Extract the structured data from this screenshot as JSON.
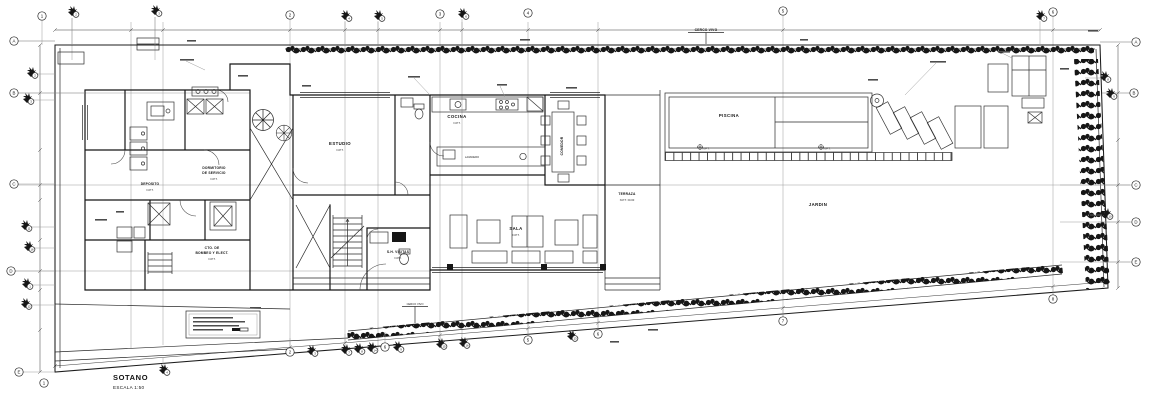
{
  "titleblock": {
    "title": "SOTANO",
    "scale": "ESCALA 1:50"
  },
  "site": {
    "top_hedge": "CERCO VIVO",
    "bottom_hedge": "CERCO VIVO",
    "jardin": "JARDIN",
    "terraza": "TERRAZA",
    "terraza_npt": "N.P.T. ±0.00"
  },
  "rooms": {
    "piscina": "PISCINA",
    "estudio": "ESTUDIO",
    "cocina": "COCINA",
    "lavadero": "LAVADERO",
    "comedor": "COMEDOR",
    "sala": "SALA",
    "dormitorio1": "DORMITORIO",
    "dormitorio2": "DE SERVICIO",
    "deposito": "DEPOSITO",
    "bombas1": "CTO. DE",
    "bombas2": "BOMBEO Y ELECT.",
    "sh_visitas": "S.H. VISITAS",
    "npt": "N.P.T."
  },
  "grid": {
    "top": [
      "1",
      "2",
      "3",
      "2",
      "4",
      "5",
      "3",
      "6",
      "4",
      "5",
      "7",
      "6"
    ],
    "left": [
      "A",
      "2",
      "3",
      "B",
      "C",
      "11",
      "16",
      "D",
      "1",
      "12",
      "E",
      "1"
    ],
    "right": [
      "A",
      "8",
      "9",
      "B",
      "C",
      "10",
      "D",
      "E"
    ],
    "bottom": [
      "2",
      "3",
      "4",
      "7",
      "8",
      "14",
      "6",
      "9",
      "15",
      "16",
      "5",
      "13",
      "6",
      "7",
      "8"
    ]
  }
}
